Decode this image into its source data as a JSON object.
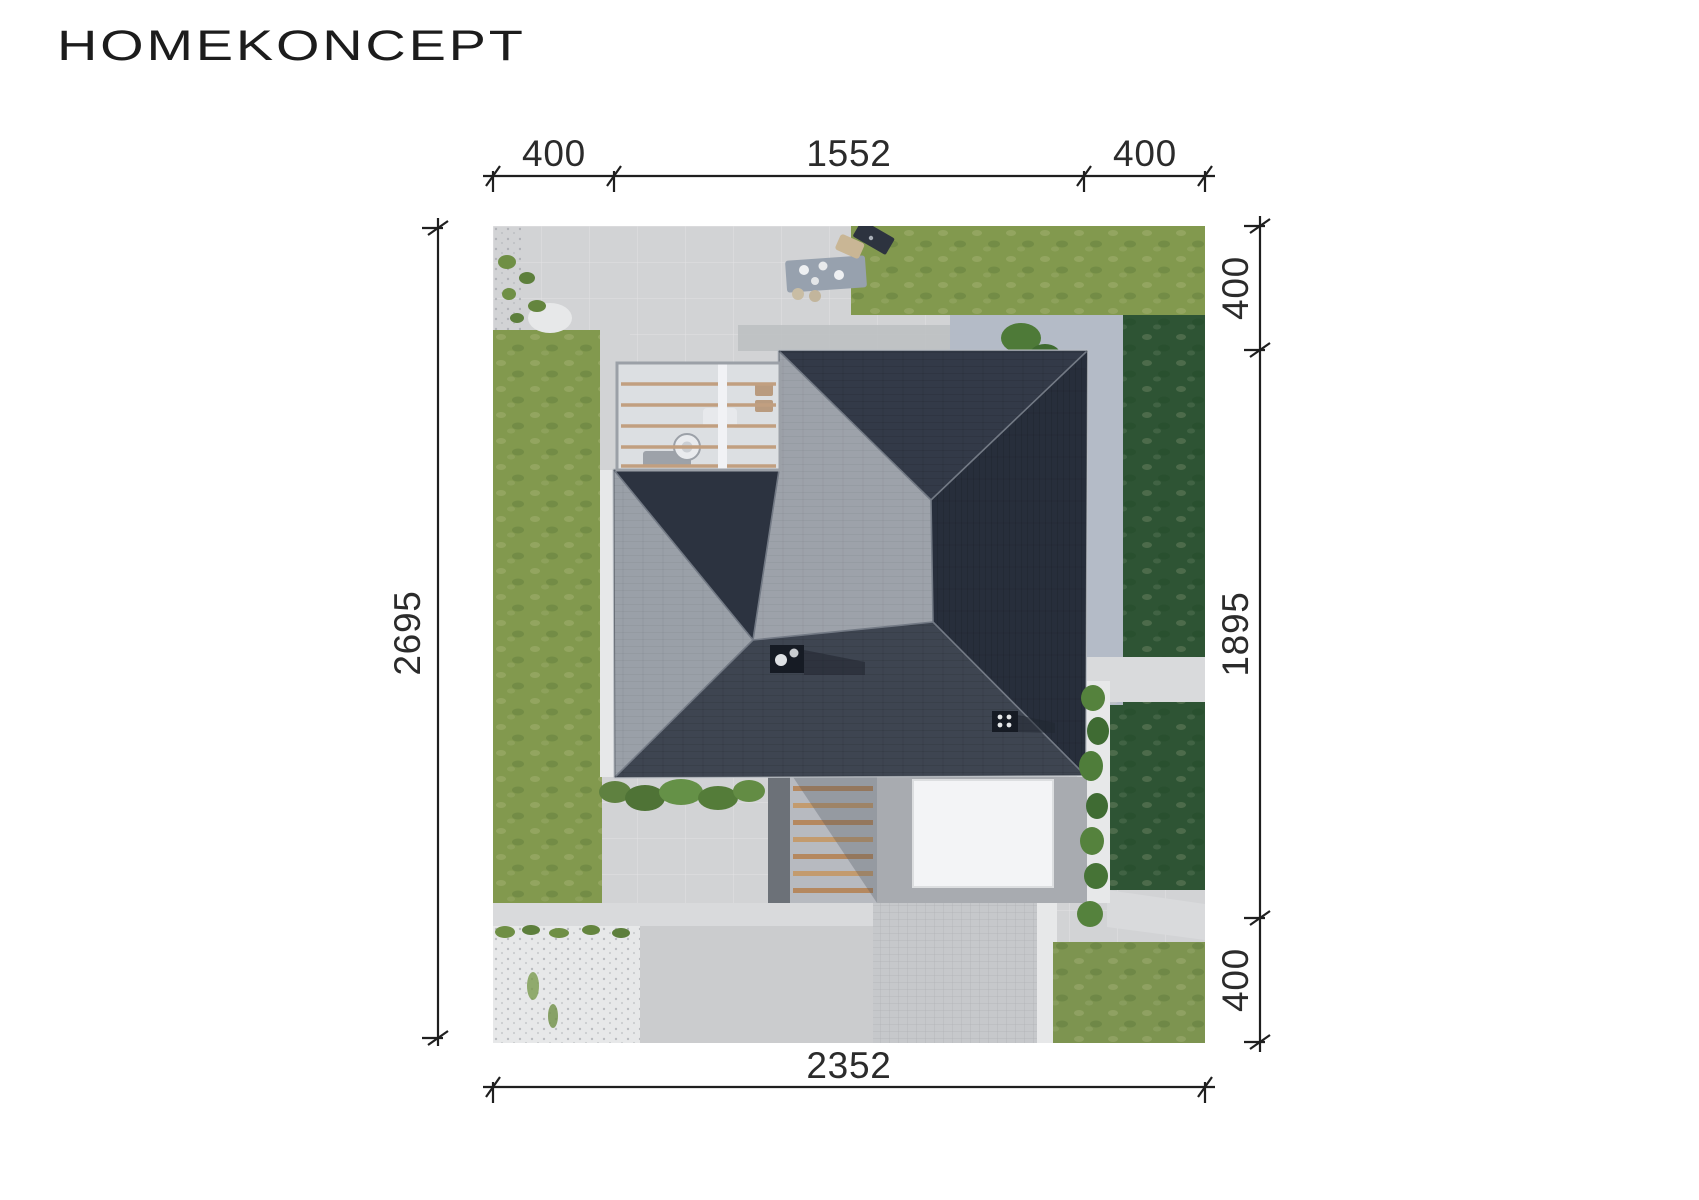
{
  "brand": {
    "logo_text": "HOMEKONCEPT"
  },
  "dimensions": {
    "ink": "#1f1f1f",
    "top": {
      "segments": [
        "400",
        "1552",
        "400"
      ]
    },
    "right": {
      "segments": [
        "400",
        "1895",
        "400"
      ]
    },
    "left": {
      "total": "2695"
    },
    "bottom": {
      "total": "2352"
    }
  },
  "site_plan": {
    "colors": {
      "paving": "#d2d3d5",
      "paving_blue": "#b4bbc7",
      "shadow": "#bcbec1",
      "driveway": "#cbccce",
      "pavers": "#c6c8cb",
      "gravel": "#e7e8e9",
      "path": "#d9dadc",
      "lawn_light": "#82994e",
      "lawn_dark": "#2e5434",
      "lawn_bottom": "#7d9450",
      "roof_north": "#333a48",
      "roof_east": "#272e3b",
      "roof_south": "#3e4551",
      "roof_mid": "#9da2aa",
      "roof_left": "#9aa0a8",
      "roof_shade": "#2c3340",
      "garage_roof": "#a8abb0",
      "skylight": "#f3f4f6",
      "wood": "#b5885f"
    }
  }
}
